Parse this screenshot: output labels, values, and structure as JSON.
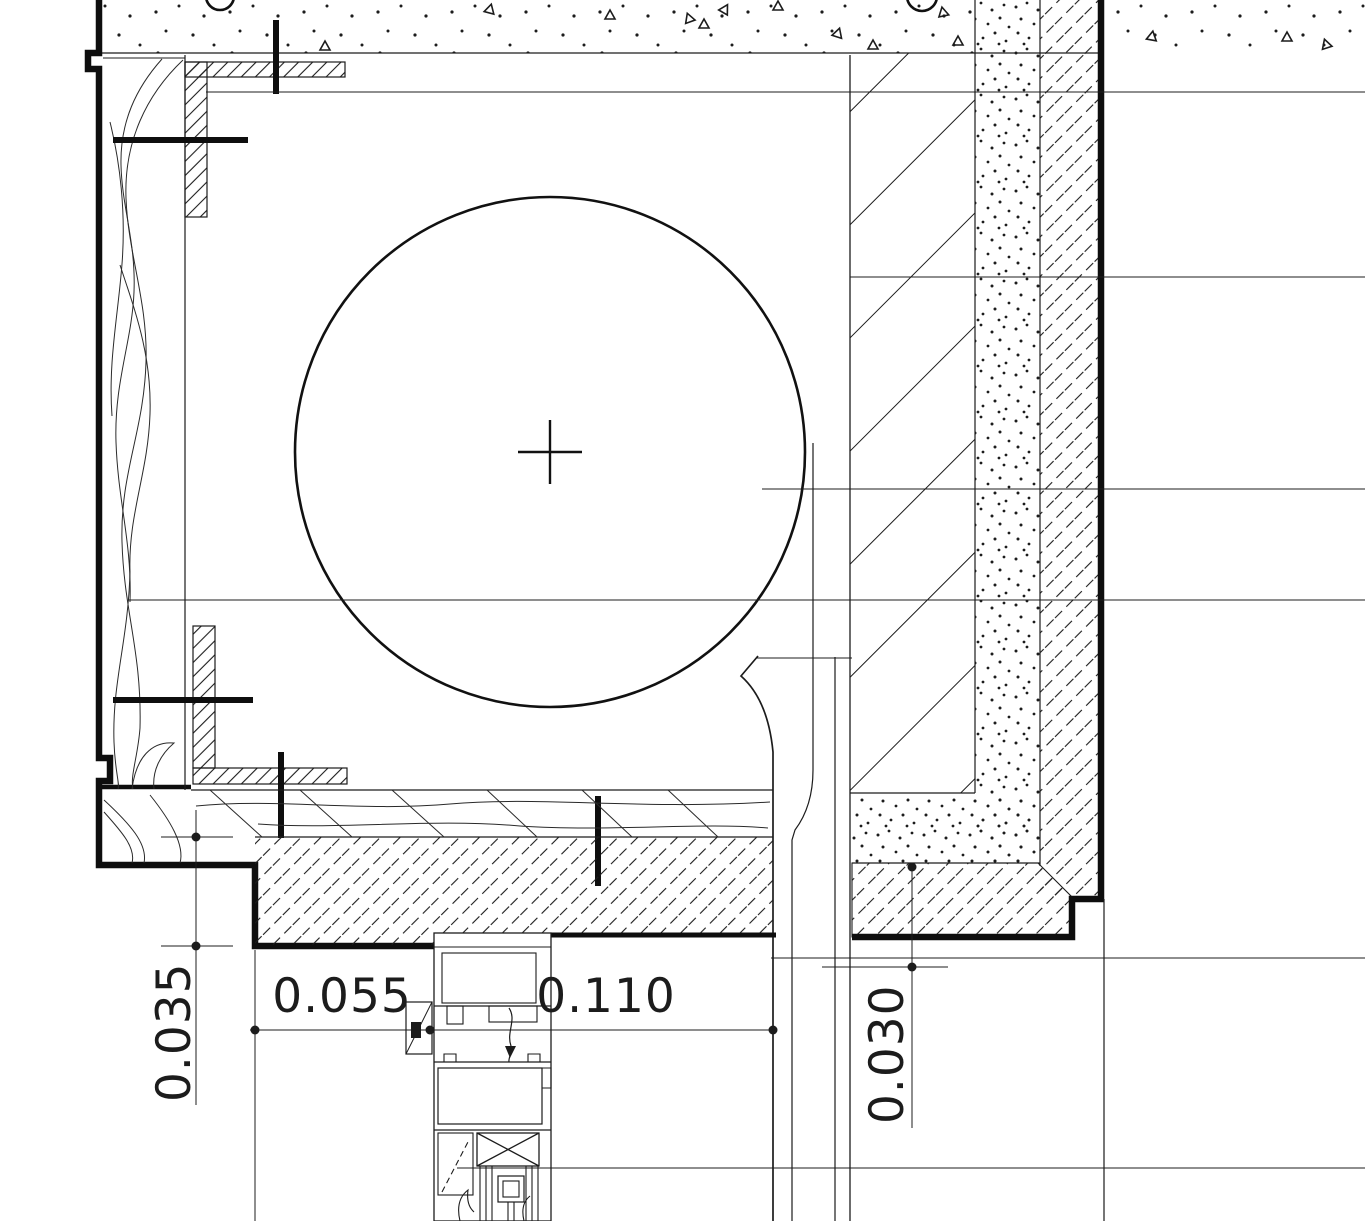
{
  "drawing": {
    "dimensions": {
      "left_step": "0.035",
      "sill_inner": "0.055",
      "sill_outer": "0.110",
      "right_soffit": "0.030"
    },
    "colors": {
      "ink": "#1c1c1c",
      "ink_heavy": "#0e0e0e",
      "paper": "#ffffff"
    }
  }
}
